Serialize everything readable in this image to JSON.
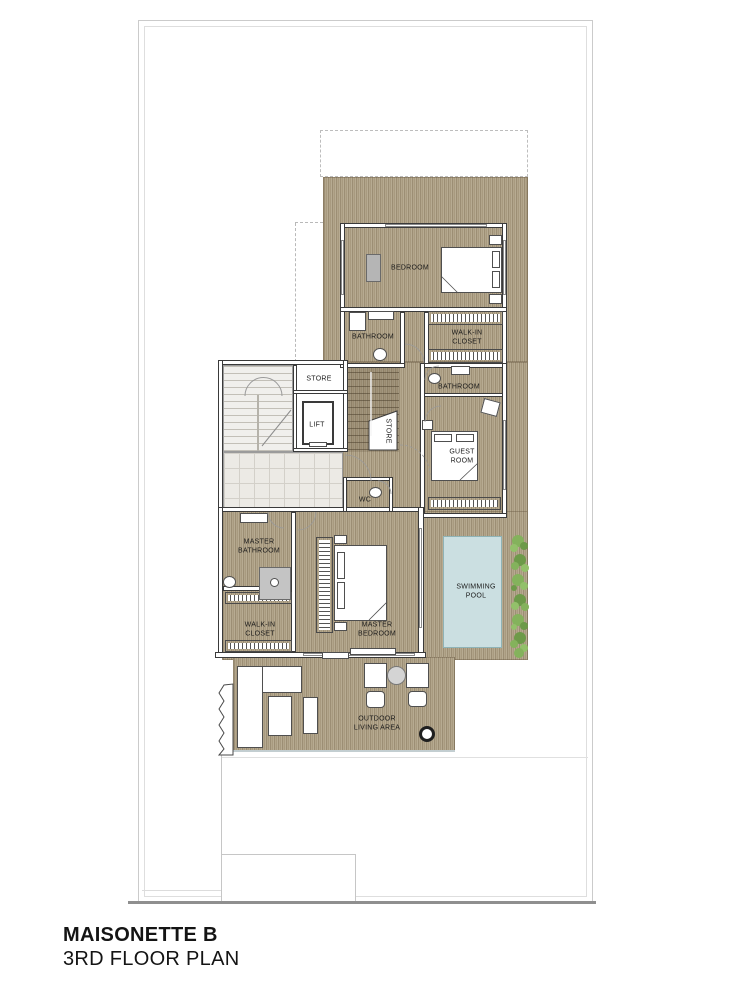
{
  "title": {
    "project": "MAISONETTE B",
    "plan": "3RD FLOOR PLAN"
  },
  "labels": {
    "bedroom": "BEDROOM",
    "bathroom_top": "BATHROOM",
    "walkin_closet_top": "WALK-IN CLOSET",
    "store_top": "STORE",
    "lift": "LIFT",
    "store_mid": "STORE",
    "bathroom_guest": "BATHROOM",
    "guest_room": "GUEST ROOM",
    "wc": "WC",
    "master_bathroom": "MASTER BATHROOM",
    "walkin_closet_master": "WALK-IN CLOSET",
    "master_bedroom": "MASTER BEDROOM",
    "swimming_pool": "SWIMMING POOL",
    "outdoor_living": "OUTDOOR LIVING AREA"
  },
  "colors": {
    "deck_wood": "#b0a388",
    "wall_line": "#3a3a3a",
    "pool_water": "#cbdfe1",
    "plant_green": "#7fae57",
    "tile_floor": "#eceae5",
    "boundary": "#c9c9c9",
    "label_text": "#1b1b1b"
  }
}
